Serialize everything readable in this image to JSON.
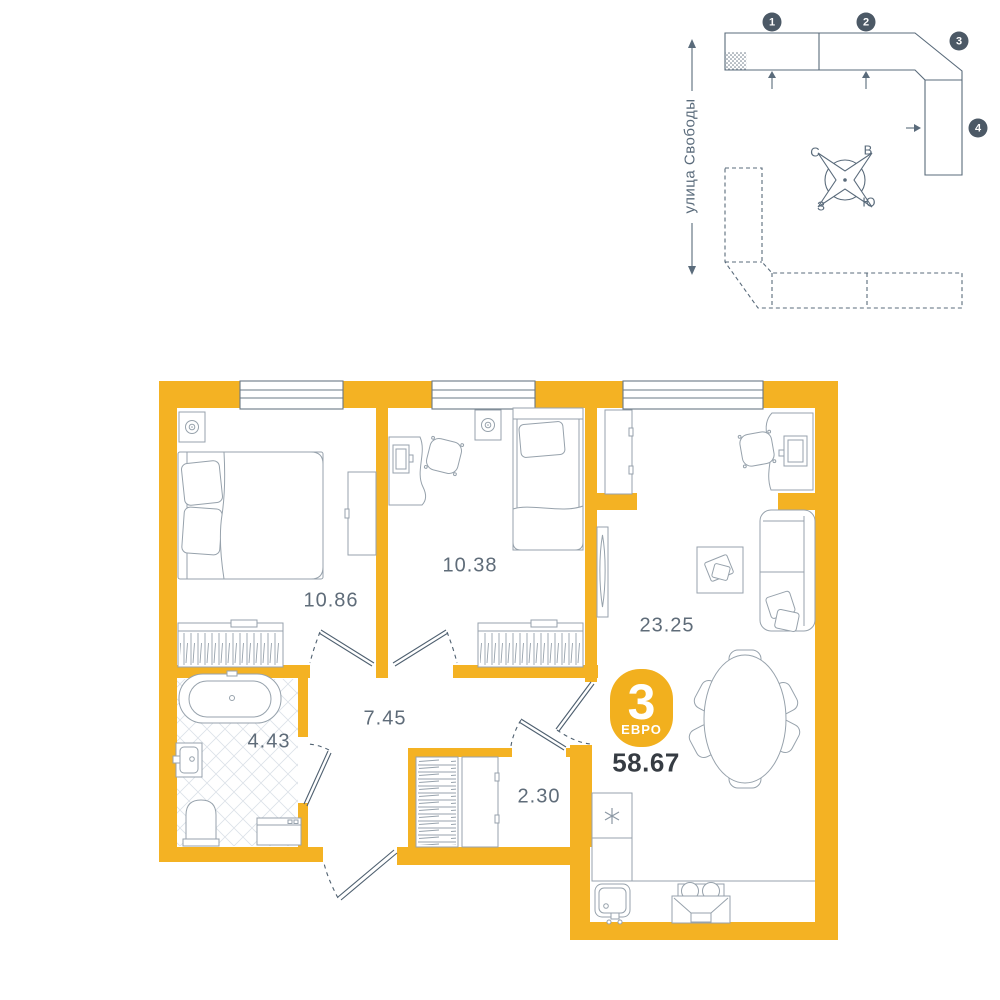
{
  "site_plan": {
    "street_label": "улица Свободы",
    "buildings": {
      "numbers": [
        "1",
        "2",
        "3",
        "4"
      ]
    },
    "compass": {
      "north": "С",
      "east": "В",
      "west": "З",
      "south": "Ю"
    }
  },
  "floor_plan": {
    "badge": {
      "rooms_count": "3",
      "layout_label": "ЕВРО"
    },
    "total_area": "58.67",
    "rooms": [
      {
        "name": "bedroom-1",
        "area": "10.86"
      },
      {
        "name": "bedroom-2",
        "area": "10.38"
      },
      {
        "name": "living-kitchen",
        "area": "23.25"
      },
      {
        "name": "hallway",
        "area": "7.45"
      },
      {
        "name": "bathroom",
        "area": "4.43"
      },
      {
        "name": "closet",
        "area": "2.30"
      }
    ]
  },
  "colors": {
    "wall": "#F4B223",
    "badge": "#F2B01E",
    "line": "#5A6B7B",
    "furniture_line": "#97A2AC",
    "area_text": "#5F6C79",
    "total_text": "#363C43",
    "number_badge": "#4C5966"
  }
}
